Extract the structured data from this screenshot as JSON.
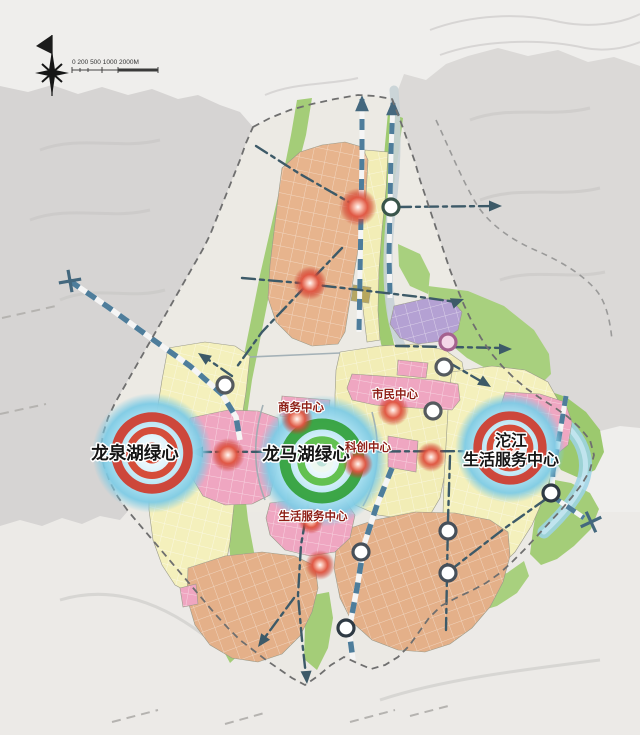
{
  "scale_bar": {
    "label": "0 200 500 1000 2000M"
  },
  "labels": {
    "major_centers": [
      {
        "id": "longquan-lake-green-heart",
        "text": "龙泉湖绿心"
      },
      {
        "id": "longma-lake-green-heart",
        "text": "龙马湖绿心"
      },
      {
        "id": "tuojiang-life-service-center",
        "line1": "沱江",
        "line2": "生活服务中心"
      }
    ],
    "sub_centers": [
      {
        "id": "business-center",
        "text": "商务中心"
      },
      {
        "id": "civic-center",
        "text": "市民中心"
      },
      {
        "id": "sci-tech-center",
        "text": "科创中心"
      },
      {
        "id": "life-service-center",
        "text": "生活服务中心"
      }
    ]
  },
  "palette": {
    "background": "#efeeec",
    "mountain_gray": "#d6d4d3",
    "greenway": "#a4cd78",
    "residential_yellow": "#f4f0bc",
    "urban_orange": "#e7b48d",
    "center_pink": "#f0a7c2",
    "special_purple": "#b4a1d3",
    "lake_glow_blue": "#7ecbe5",
    "river_cyan": "#9cd3e8",
    "rail_blue": "#4e7d9b",
    "axis_dark": "#3d5a68",
    "red_marker": "#d03a2a",
    "green_heart_ring": "#2f9e34",
    "sub_label_red": "#8e1d15"
  },
  "markers": {
    "bullseyes": [
      {
        "x": 152,
        "y": 453,
        "style": "red",
        "scale": 1.0
      },
      {
        "x": 322,
        "y": 461,
        "style": "green",
        "scale": 1.0
      },
      {
        "x": 510,
        "y": 448,
        "style": "red",
        "scale": 0.9
      }
    ],
    "red_glow_points": [
      [
        358,
        207,
        19
      ],
      [
        310,
        283,
        17
      ],
      [
        297,
        419,
        16
      ],
      [
        393,
        410,
        16
      ],
      [
        358,
        464,
        15
      ],
      [
        431,
        457,
        15
      ],
      [
        228,
        455,
        17
      ],
      [
        311,
        521,
        13
      ],
      [
        320,
        565,
        15
      ]
    ],
    "station_points": [
      [
        391,
        207,
        "#39544a",
        "#ffffff"
      ],
      [
        225,
        385,
        "#555a5e",
        "#ffffff"
      ],
      [
        448,
        342,
        "#a5628f",
        "#f4d7e8"
      ],
      [
        444,
        367,
        "#555a5e",
        "#ffffff"
      ],
      [
        433,
        411,
        "#555a5e",
        "#ffffff"
      ],
      [
        361,
        552,
        "#47505a",
        "#ffffff"
      ],
      [
        346,
        628,
        "#2f3a44",
        "#ffffff"
      ],
      [
        448,
        531,
        "#47505a",
        "#ffffff"
      ],
      [
        448,
        573,
        "#47505a",
        "#ffffff"
      ],
      [
        551,
        493,
        "#2f3a44",
        "#ffffff"
      ]
    ]
  }
}
